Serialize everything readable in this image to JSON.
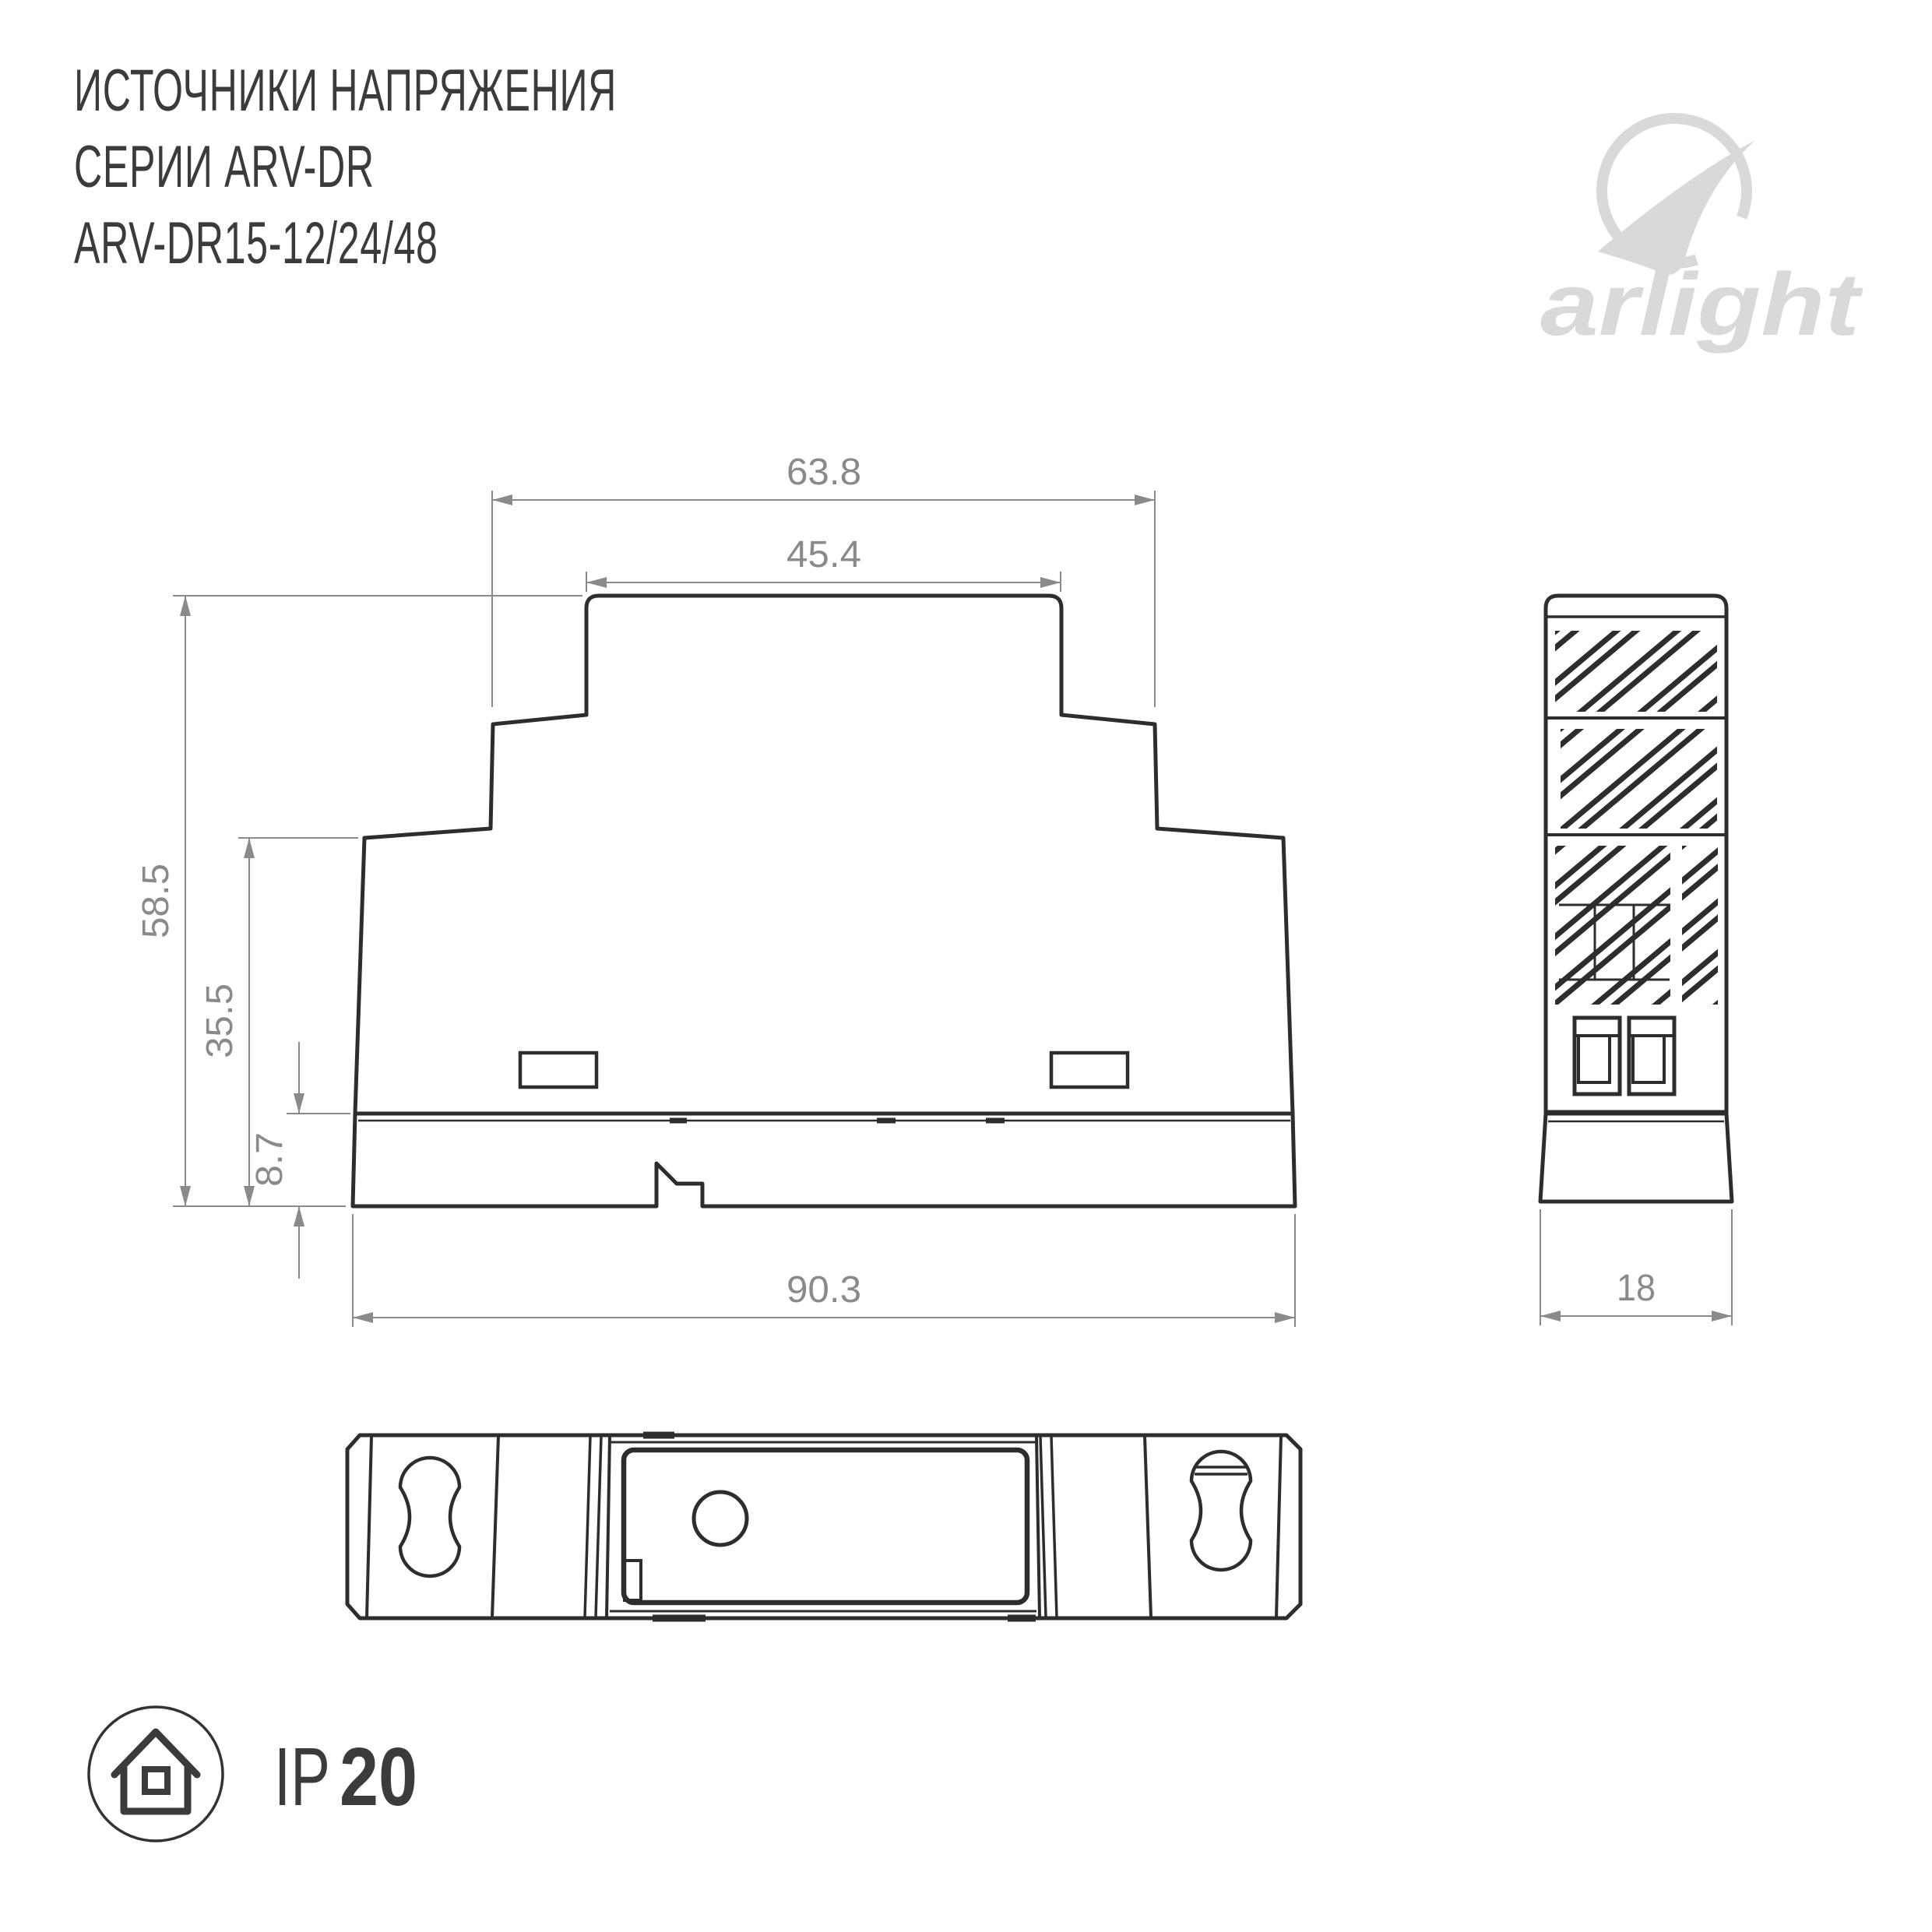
{
  "title": {
    "line1": "ИСТОЧНИКИ НАПРЯЖЕНИЯ",
    "line2": "СЕРИИ ARV-DR",
    "line3": "ARV-DR15-12/24/48"
  },
  "logo": {
    "brand": "arlight"
  },
  "drawing": {
    "front_view": {
      "dim_step_width": "63.8",
      "dim_top_width": "45.4",
      "dim_total_height": "58.5",
      "dim_body_height": "35.5",
      "dim_base_height": "8.7",
      "dim_total_width": "90.3"
    },
    "side_view": {
      "dim_width": "18"
    }
  },
  "badge": {
    "prefix": "IP",
    "rating": "20"
  },
  "colors": {
    "object_lines": "#2d2d2d",
    "dimension_lines": "#8a8a8a",
    "title_text": "#3b3b3b",
    "logo_gray": "#d9d9d9",
    "background": "#ffffff"
  }
}
